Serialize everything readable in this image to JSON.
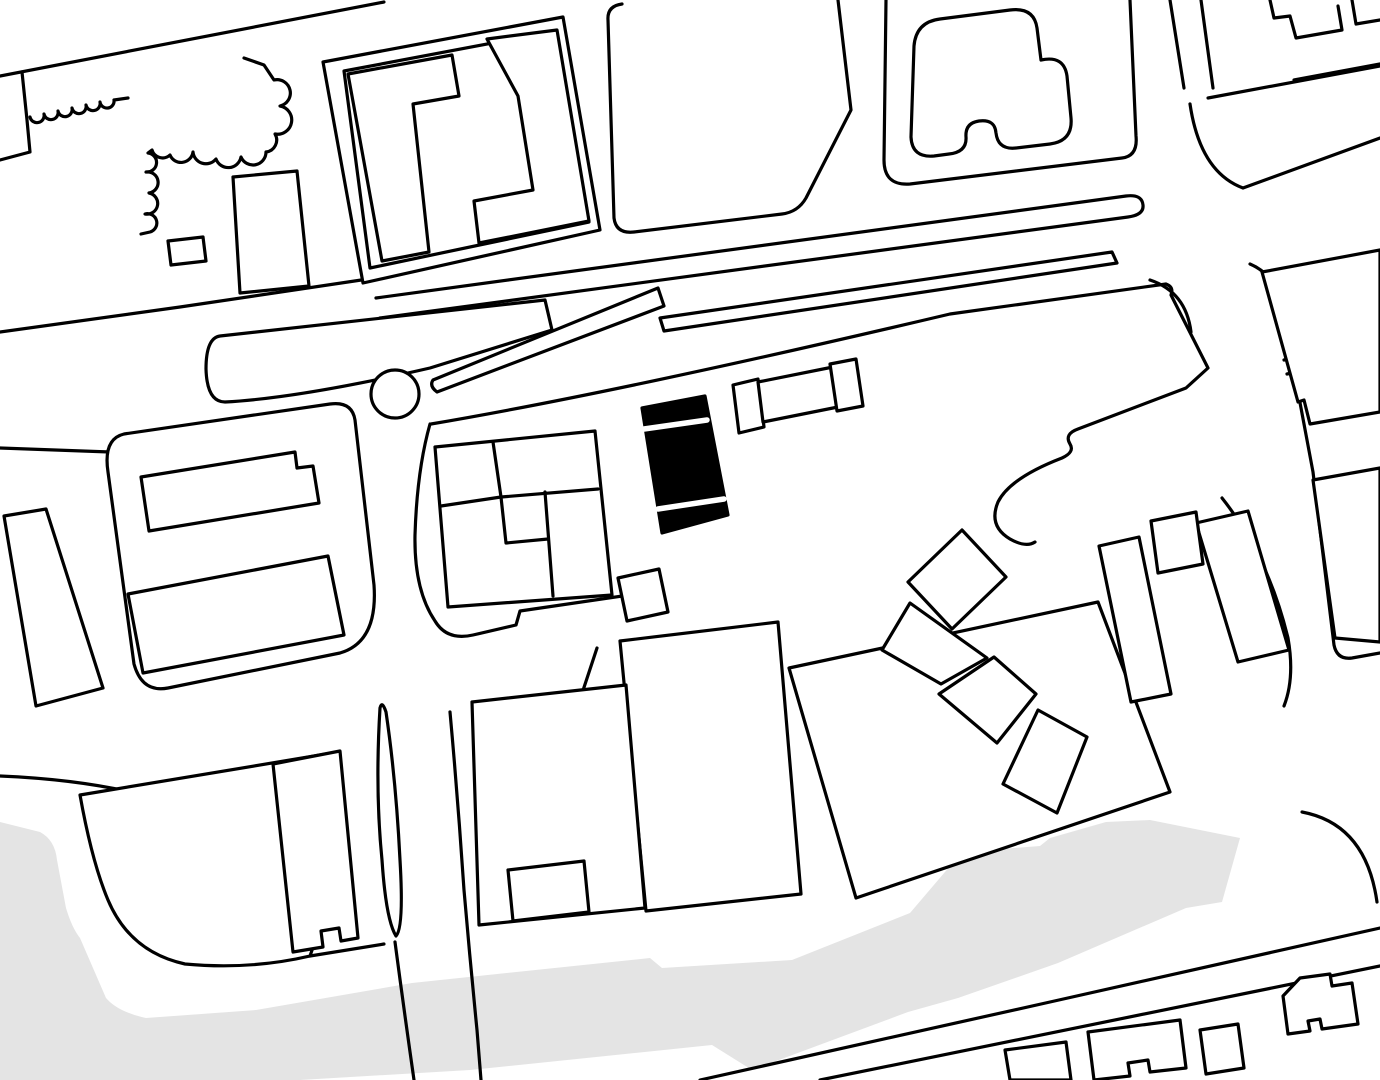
{
  "canvas": {
    "width": 1380,
    "height": 1080,
    "background_color": "#ffffff",
    "line_color": "#000000",
    "line_width": 3.2,
    "water_color": "#e4e4e4",
    "building_fill": "#ffffff",
    "highlight_fill": "#000000",
    "divider_color": "#ffffff",
    "divider_width": 5.5
  },
  "map": {
    "water": [
      {
        "name": "river-band",
        "d": "M 0,822 L 40,832 Q 55,840 57,860 L 66,908 Q 72,928 80,938 L 106,998 Q 118,1012 146,1018 L 256,1010 L 412,983 L 650,958 L 662,968 L 792,960 L 910,913 L 962,852 L 1040,846 L 1050,838 L 1106,822 L 1150,820 L 1240,838 L 1222,902 L 1186,908 L 1058,963 L 958,998 L 908,1012 L 752,1070 L 712,1045 L 470,1070 L 300,1080 L 0,1080 Z"
      }
    ],
    "streets": [
      {
        "name": "street-topleft-diagonal",
        "d": "M 0,76 L 384,2"
      },
      {
        "name": "street-topleft-parcel-edge",
        "d": "M 22,72 L 27,120 L 30,152 L 0,160"
      },
      {
        "name": "scalloped-wall",
        "d": "M 30,117 A 7 7 0 0 0 44,114 A 7 7 0 0 0 58,111 A 7 7 0 0 0 72,108 A 7 7 0 0 0 86,105 A 7 7 0 0 0 100,102 A 7 7 0 0 0 114,100 L 128,98"
      },
      {
        "name": "street-topblocks-south-edge",
        "d": "M 0,332 L 180,307 L 368,279"
      },
      {
        "name": "tram-strip",
        "d": "M 376,298 L 1126,196 Q 1142,194 1143,205 Q 1144,215 1128,217 L 380,318"
      },
      {
        "name": "street-left-stub",
        "d": "M 0,448 L 110,452"
      },
      {
        "name": "plaza-north-boundary",
        "d": "M 431,424 Q 620,392 950,314 L 1166,284 Q 1174,287 1171,295 L 1208,368 L 1186,388 L 1078,429 Q 1064,434 1070,444 Q 1075,452 1062,458 Q 1010,478 998,502 Q 988,526 1010,539 Q 1026,548 1035,542"
      },
      {
        "name": "plaza-west-boundary",
        "d": "M 430,424 Q 417,470 415,535 Q 414,590 435,621 Q 447,641 473,635 L 516,625 L 520,611 L 650,592"
      },
      {
        "name": "street-upper-right-west-edge",
        "d": "M 1170,0 L 1184,88"
      },
      {
        "name": "street-upper-right-east-edge",
        "d": "M 1201,0 L 1213,88"
      },
      {
        "name": "street-upper-right-corner-curve",
        "d": "M 1190,104 Q 1200,172 1243,188 L 1380,138"
      },
      {
        "name": "street-topright-avenue-edge",
        "d": "M 1208,98 L 1380,66"
      },
      {
        "name": "street-right-west-corner",
        "d": "M 1150,280 Q 1186,292 1191,332"
      },
      {
        "name": "street-right-east-edge",
        "d": "M 1250,264 Q 1283,278 1286,328 L 1313,472 L 1334,645 Q 1337,660 1352,658 L 1380,653"
      },
      {
        "name": "street-bottomright-edge-1",
        "d": "M 700,1080 L 1050,1002 L 1380,928"
      },
      {
        "name": "street-bottomright-edge-2",
        "d": "M 820,1080 L 1380,966"
      },
      {
        "name": "street-bottomright-corner-curve",
        "d": "M 1302,812 Q 1366,824 1377,902"
      },
      {
        "name": "street-bottomleft-corner-curve",
        "d": "M 0,776 Q 140,782 215,822 Q 262,848 283,905"
      },
      {
        "name": "street-south-connector",
        "d": "M 310,956 L 384,944"
      },
      {
        "name": "v-street-left-edge",
        "d": "M 395,942 Q 404,1010 414,1080"
      },
      {
        "name": "v-street-right-edge",
        "d": "M 450,712 Q 458,800 464,890 Q 470,960 477,1030 L 481,1080"
      },
      {
        "name": "triangle-parcel-lines",
        "d": "M 597,648 L 563,751 L 630,780"
      },
      {
        "name": "street-curve-right-of-bars",
        "d": "M 1222,498 Q 1268,556 1288,638 Q 1295,678 1284,706"
      },
      {
        "name": "topright-building-baseline",
        "d": "M 1294,80 L 1380,64"
      },
      {
        "name": "balcony-tick-1",
        "d": "M 1284,360 L 1298,357"
      },
      {
        "name": "balcony-tick-2",
        "d": "M 1287,374 L 1301,371"
      },
      {
        "name": "topright-parapet-1",
        "d": "M 1270,0 L 1274,18 L 1290,16 L 1296,38 L 1342,30 L 1338,6"
      },
      {
        "name": "topright-parapet-2",
        "d": "M 1352,0 L 1356,24 L 1380,20"
      }
    ],
    "islands": [
      {
        "name": "median-island",
        "d": "M 220,336 L 545,300 L 552,330 L 430,368 Q 300,398 225,402 Q 207,402 206,369 Q 206,338 220,336 Z"
      },
      {
        "name": "wedge-island",
        "d": "M 433,380 L 658,288 L 664,306 L 437,392 Q 429,386 433,380 Z"
      },
      {
        "name": "tram-wedge-island",
        "d": "M 660,318 L 1112,252 L 1117,263 L 664,331 Z"
      },
      {
        "name": "roundabout",
        "d": "M 371,394 A 24 24 0 1 0 419,394 A 24 24 0 1 0 371,394 Z"
      },
      {
        "name": "sliver-island",
        "d": "M 380,708 Q 375,790 382,860 Q 386,920 396,936 Q 404,928 400,860 Q 396,780 386,712 Q 382,700 380,708 Z"
      },
      {
        "name": "leaf-parcel",
        "d": "M 80,795 L 338,752 Q 345,860 310,956 Q 250,970 185,964 Q 130,952 108,900 Q 92,862 80,795 Z"
      }
    ],
    "blocks": [
      {
        "name": "block-pinwheel-outer",
        "d": "M 323,62 L 563,17 L 600,230 L 363,283 Z"
      },
      {
        "name": "block-pinwheel-inner",
        "d": "M 344,71 L 556,31 L 589,222 L 370,268 Z",
        "fill": "none"
      },
      {
        "name": "block-top-center-rounded",
        "d": "M 838,0 L 851,110 L 806,198 Q 798,212 782,214 L 634,232 Q 616,234 614,218 L 608,20 Q 607,6 622,4",
        "fill": "none"
      },
      {
        "name": "block-top-mid-right",
        "d": "M 886,0 L 884,160 Q 884,186 910,184 L 1122,158 Q 1138,156 1136,136 L 1130,0",
        "fill": "none"
      },
      {
        "name": "block-mid-left-rounded",
        "d": "M 124,434 L 330,404 Q 352,401 355,420 L 374,585 Q 378,642 340,653 L 168,688 Q 142,693 134,664 L 108,472 Q 103,439 124,434 Z"
      },
      {
        "name": "block-square-cluster-outer",
        "d": "M 435,447 L 595,431 L 612,595 L 448,607 Z"
      },
      {
        "name": "cluster-partition-1",
        "d": "M 493,442 L 501,497",
        "fill": "none"
      },
      {
        "name": "cluster-partition-2",
        "d": "M 441,506 L 501,497",
        "fill": "none"
      },
      {
        "name": "cluster-partition-3",
        "d": "M 501,497 L 598,489",
        "fill": "none"
      },
      {
        "name": "cluster-partition-4",
        "d": "M 545,492 L 553,596",
        "fill": "none"
      },
      {
        "name": "cluster-partition-5",
        "d": "M 501,497 L 506,543 L 548,539",
        "fill": "none"
      }
    ],
    "buildings": [
      {
        "name": "building-cloud-scalloped",
        "d": "M 244,58 L 264,65 L 274,80 A 13 13 0 0 1 280,106 A 13 13 0 0 1 275,134 A 12 12 0 0 1 266,152 A 13 13 0 0 1 241,157 A 13 13 0 0 1 216,159 A 13 13 0 0 1 193,152 A 12 12 0 0 1 170,155 A 11 11 0 0 1 152,150 L 148,153 A 9 9 0 0 1 146,172 A 9 9 0 0 1 149,193 A 9 9 0 0 1 145,214 A 9 9 0 0 1 150,232 L 141,234",
        "fill": "none"
      },
      {
        "name": "building-topleft-tall",
        "d": "M 233,177 L 297,171 L 309,286 L 240,293 Z"
      },
      {
        "name": "building-topleft-small",
        "d": "M 168,241 L 203,237 L 206,261 L 171,265 Z"
      },
      {
        "name": "building-pinwheel-west",
        "d": "M 348,74 L 452,55 L 459,96 L 413,104 L 429,252 L 382,261 Z"
      },
      {
        "name": "building-pinwheel-east",
        "d": "M 487,39 L 557,30 L 589,221 L 479,243 L 474,201 L 533,190 L 518,96 Z"
      },
      {
        "name": "building-blob-topright-block",
        "d": "M 914,46 Q 916,22 940,19 L 1010,10 Q 1034,7 1037,28 L 1041,60 Q 1064,55 1067,76 L 1071,118 Q 1073,141 1050,144 L 1016,148 Q 998,150 996,133 Q 995,119 979,121 Q 965,123 966,137 Q 967,152 949,154 L 934,156 Q 912,158 911,137 Z"
      },
      {
        "name": "building-midleft-bar-upper",
        "d": "M 141,477 L 295,452 L 297,468 L 313,466 L 319,503 L 149,531 Z"
      },
      {
        "name": "building-midleft-bar-lower",
        "d": "M 128,594 L 328,556 L 344,635 L 143,673 Z"
      },
      {
        "name": "building-left-angled",
        "d": "M 4,516 L 46,509 L 103,688 L 36,706 Z"
      },
      {
        "name": "building-clapper-bar",
        "d": "M 618,578 L 659,569 L 668,612 L 627,621 Z"
      },
      {
        "name": "building-slab-parallelogram",
        "d": "M 789,668 L 1098,602 L 1170,792 L 856,898 Z"
      },
      {
        "name": "building-central-rect",
        "d": "M 620,641 L 778,622 L 801,894 L 646,911 Z"
      },
      {
        "name": "building-bottom-center",
        "d": "M 472,702 L 626,685 L 645,908 L 479,925 Z"
      },
      {
        "name": "building-bottom-center-annex",
        "d": "M 508,870 L 584,861 L 589,912 L 513,921 Z"
      },
      {
        "name": "building-notched-tall",
        "d": "M 273,764 L 340,751 L 358,938 L 341,941 L 339,928 L 321,931 L 323,947 L 293,952 Z"
      },
      {
        "name": "building-cascade-square-1",
        "d": "M 908,582 L 962,530 L 1006,577 L 952,629 Z"
      },
      {
        "name": "building-cascade-square-2",
        "d": "M 882,650 L 910,603 L 987,658 L 941,684 Z"
      },
      {
        "name": "building-cascade-square-3",
        "d": "M 939,694 L 994,657 L 1036,694 L 997,743 Z"
      },
      {
        "name": "building-cascade-square-4",
        "d": "M 1003,784 L 1038,710 L 1087,737 L 1057,813 Z"
      },
      {
        "name": "building-slant-bar-1",
        "d": "M 1099,546 L 1139,537 L 1171,694 L 1131,702 Z"
      },
      {
        "name": "building-slant-bar-2",
        "d": "M 1196,523 L 1248,511 L 1289,650 L 1238,662 Z"
      },
      {
        "name": "building-slant-square",
        "d": "M 1151,521 L 1196,512 L 1203,564 L 1158,573 Z"
      },
      {
        "name": "building-right-upper",
        "d": "M 1262,272 L 1380,250 L 1380,412 L 1310,424 L 1304,400 L 1298,402 Z"
      },
      {
        "name": "building-right-lower",
        "d": "M 1313,480 L 1380,468 L 1380,642 L 1335,638 Z"
      },
      {
        "name": "building-bottomright-1",
        "d": "M 1005,1050 L 1066,1042 L 1071,1080 L 1010,1080 Z"
      },
      {
        "name": "building-bottomright-2",
        "d": "M 1088,1032 L 1180,1020 L 1186,1068 L 1150,1072 L 1148,1060 L 1128,1063 L 1130,1076 L 1094,1080 Z"
      },
      {
        "name": "building-bottomright-3",
        "d": "M 1200,1030 L 1238,1024 L 1244,1068 L 1206,1074 Z"
      },
      {
        "name": "building-bottomright-4",
        "d": "M 1283,996 L 1300,978 L 1330,974 L 1332,986 L 1352,983 L 1358,1024 L 1322,1029 L 1320,1019 L 1308,1021 L 1310,1031 L 1288,1034 Z"
      },
      {
        "name": "building-barbell-left",
        "d": "M 733,385 L 758,379 L 764,427 L 739,433 Z"
      },
      {
        "name": "building-barbell-middle",
        "d": "M 758,382 L 833,367 L 838,407 L 763,422 Z"
      },
      {
        "name": "building-barbell-right",
        "d": "M 830,364 L 856,359 L 863,406 L 837,411 Z"
      }
    ],
    "highlight": {
      "name": "highlighted-project-building",
      "outline": "M 642,408 L 705,396 L 728,515 L 662,533 Z",
      "dividers": [
        {
          "name": "highlight-divider-1",
          "d": "M 644,429 L 707,420"
        },
        {
          "name": "highlight-divider-2",
          "d": "M 658,509 L 724,499"
        }
      ]
    }
  }
}
